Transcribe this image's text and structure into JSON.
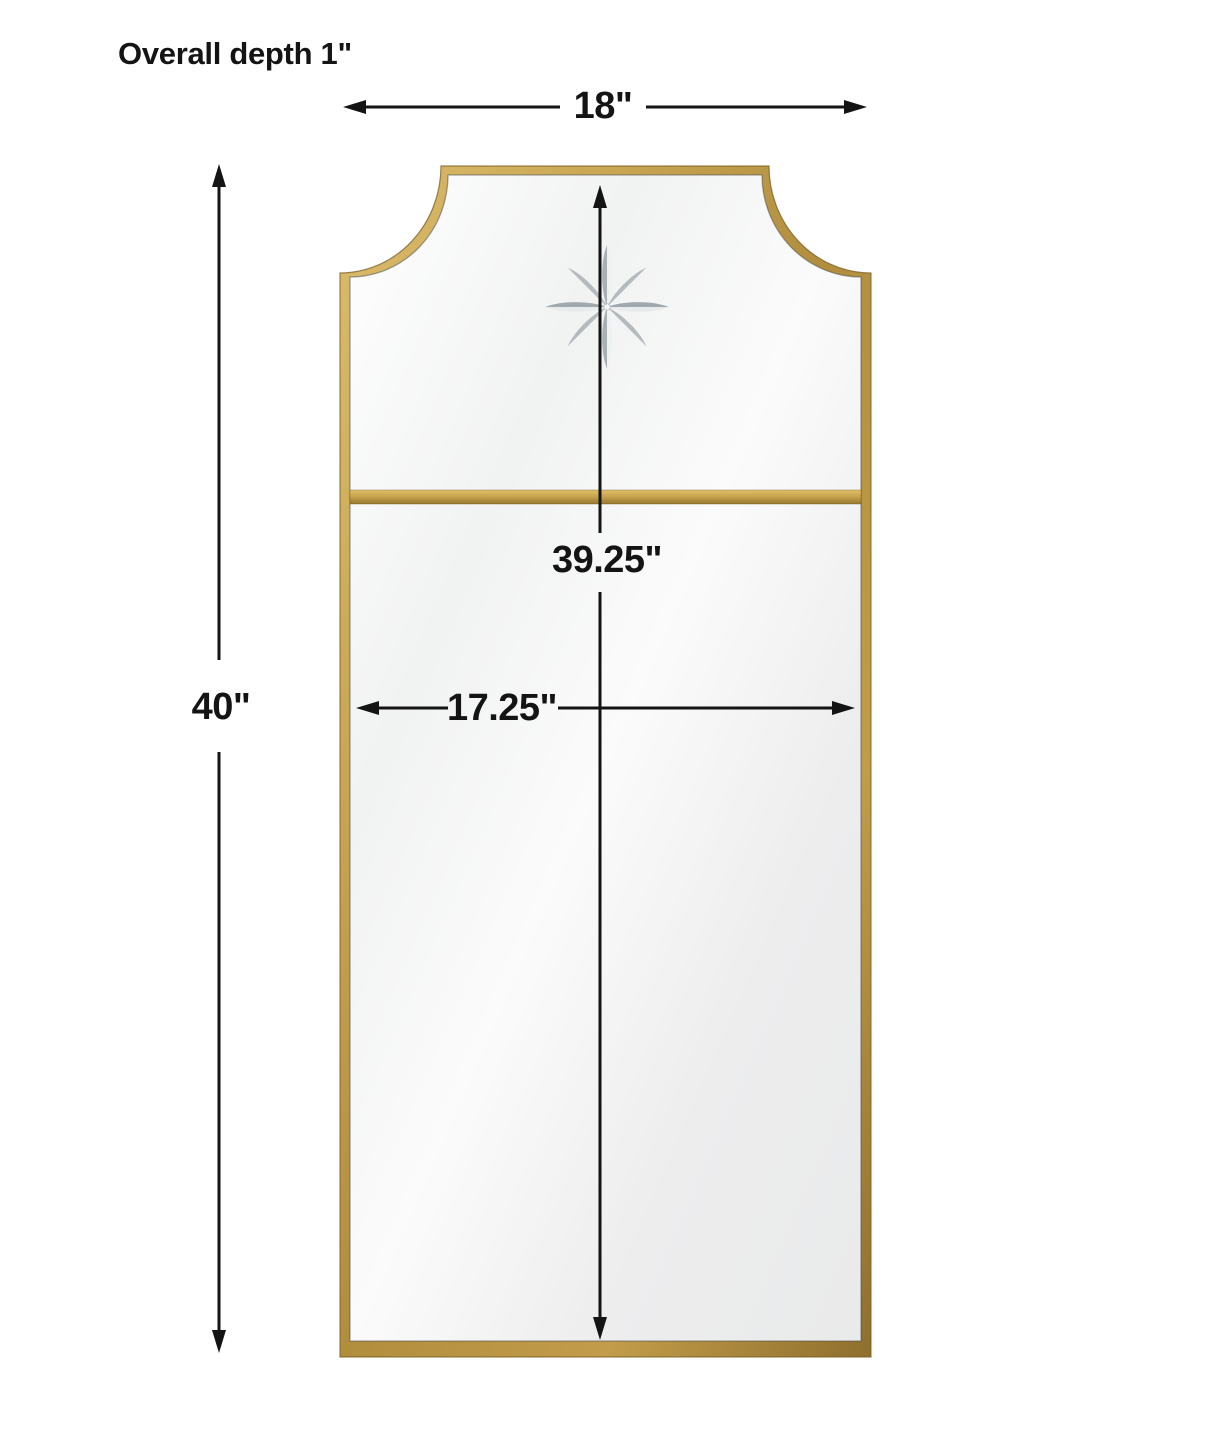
{
  "title": "Overall depth 1\"",
  "dimensions": {
    "overall_width": "18\"",
    "overall_height": "40\"",
    "glass_height": "39.25\"",
    "glass_width": "17.25\""
  },
  "colors": {
    "background": "#ffffff",
    "dimension_line": "#141414",
    "frame_gold": "#bb9646",
    "frame_gold_light": "#dcbd6f",
    "frame_gold_dark": "#8a6c2a",
    "glass_light": "#fbfbfb",
    "glass_shade": "#e9eaea",
    "star_dark": "#a9b0b4",
    "star_light": "#eef1f2"
  },
  "illustration": {
    "subject": "arch-top rectangular wall mirror with gold metal frame, etched eight-point star, and horizontal gold divider bar"
  }
}
